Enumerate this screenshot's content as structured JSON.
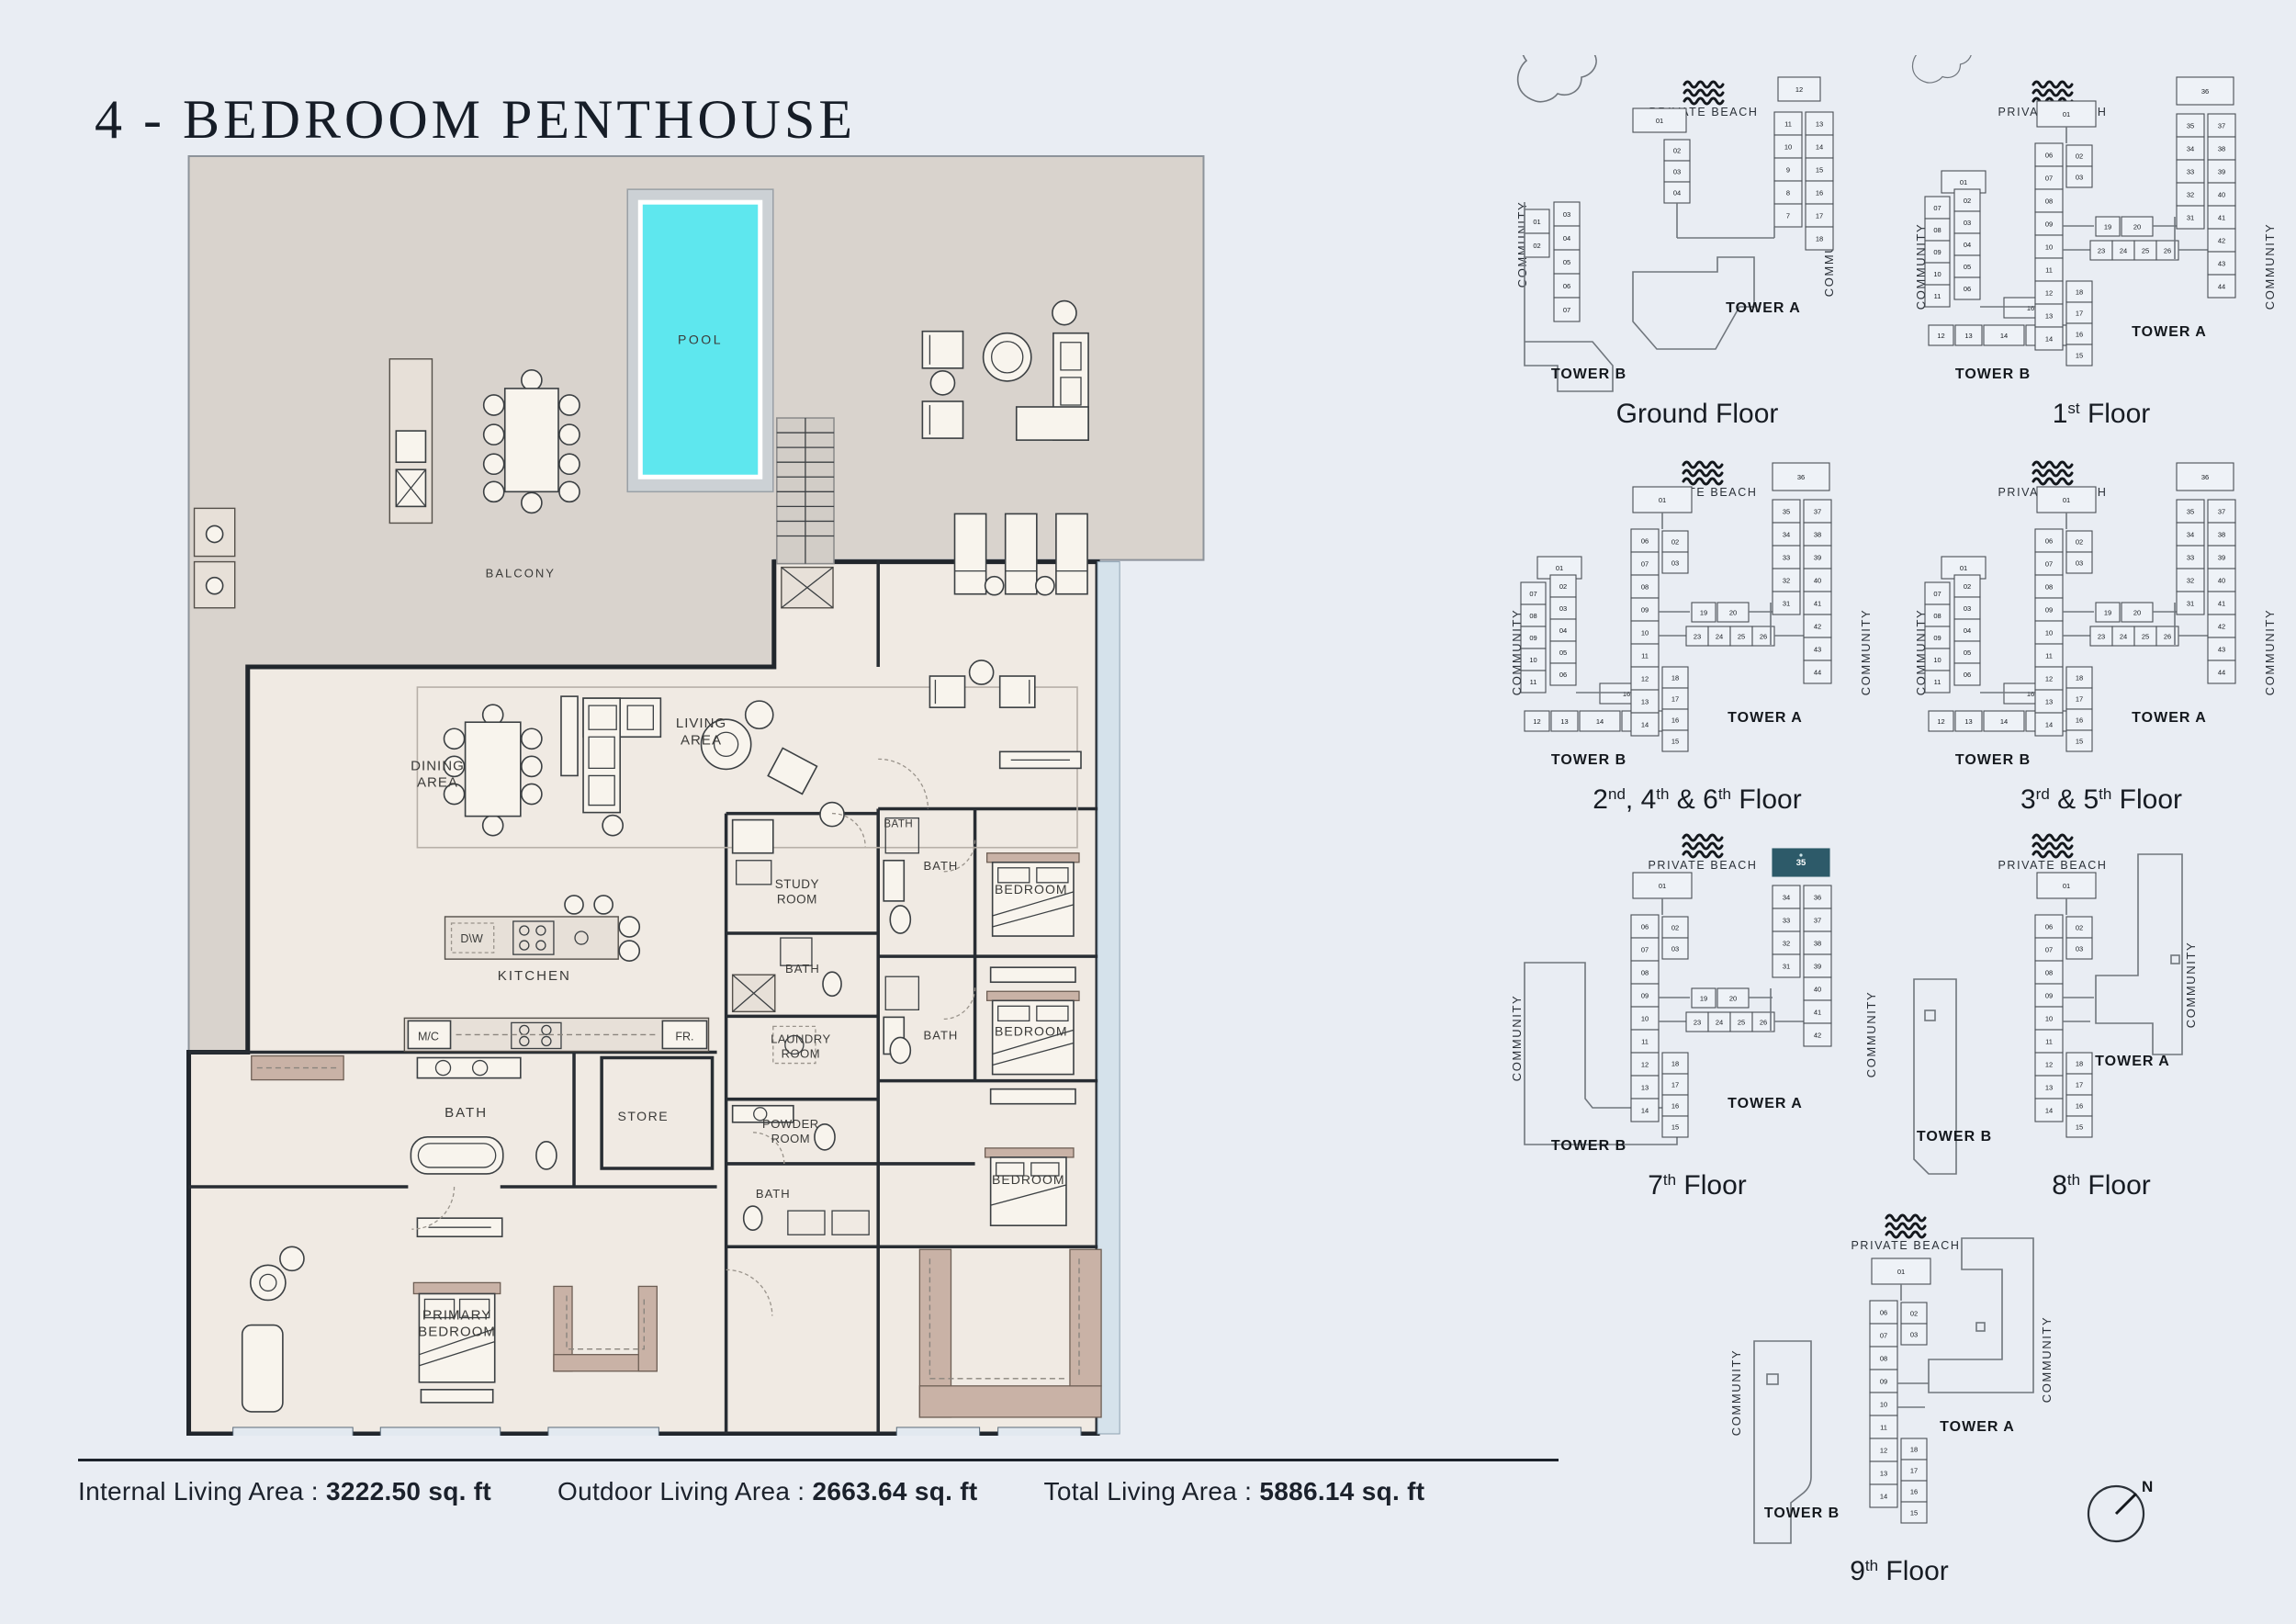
{
  "title": "4 - BEDROOM PENTHOUSE",
  "colors": {
    "highlight": "#2d5a69",
    "pool": "#5ee7ee",
    "background": "#e9edf3"
  },
  "plan": {
    "rooms": [
      {
        "id": "pool",
        "lines": [
          "POOL"
        ]
      },
      {
        "id": "balcony",
        "lines": [
          "BALCONY"
        ]
      },
      {
        "id": "dining",
        "lines": [
          "DINING",
          "AREA"
        ]
      },
      {
        "id": "living",
        "lines": [
          "LIVING",
          "AREA"
        ]
      },
      {
        "id": "kitchen",
        "lines": [
          "KITCHEN"
        ]
      },
      {
        "id": "dw",
        "lines": [
          "D\\W"
        ]
      },
      {
        "id": "mc",
        "lines": [
          "M/C"
        ]
      },
      {
        "id": "fr",
        "lines": [
          "FR."
        ]
      },
      {
        "id": "bath_main",
        "lines": [
          "BATH"
        ]
      },
      {
        "id": "store",
        "lines": [
          "STORE"
        ]
      },
      {
        "id": "primary",
        "lines": [
          "PRIMARY",
          "BEDROOM"
        ]
      },
      {
        "id": "study",
        "lines": [
          "STUDY",
          "ROOM"
        ]
      },
      {
        "id": "bath_study",
        "lines": [
          "BATH"
        ]
      },
      {
        "id": "laundry",
        "lines": [
          "LAUNDRY",
          "ROOM"
        ]
      },
      {
        "id": "powder",
        "lines": [
          "POWDER",
          "ROOM"
        ]
      },
      {
        "id": "bath_lower",
        "lines": [
          "BATH"
        ]
      },
      {
        "id": "bath_top",
        "lines": [
          "BATH"
        ]
      },
      {
        "id": "bath_en1",
        "lines": [
          "BATH"
        ]
      },
      {
        "id": "bath_en2",
        "lines": [
          "BATH"
        ]
      },
      {
        "id": "bedroom_1",
        "lines": [
          "BEDROOM"
        ]
      },
      {
        "id": "bedroom_2",
        "lines": [
          "BEDROOM"
        ]
      },
      {
        "id": "bedroom_3",
        "lines": [
          "BEDROOM"
        ]
      }
    ]
  },
  "keyplans": {
    "shared": {
      "private_beach": "PRIVATE BEACH",
      "community": "COMMUNITY",
      "tower_a": "TOWER A",
      "tower_b": "TOWER B"
    },
    "floors": [
      {
        "id": "ground",
        "caption": [
          {
            "t": "Ground Floor"
          }
        ],
        "tower_a": {
          "variant": "ground",
          "top01": "01",
          "side_col": [
            "02",
            "03",
            "04"
          ],
          "wing_top": "12",
          "pairs_left": [
            "11",
            "10",
            "9",
            "8",
            "7"
          ],
          "pairs_right": [
            "13",
            "14",
            "15",
            "16",
            "17"
          ],
          "tail": [
            "18"
          ]
        },
        "tower_b": {
          "variant": "ground",
          "left": [
            "01",
            "02"
          ],
          "right": [
            "03",
            "04",
            "05",
            "06",
            "07"
          ],
          "lagoon": true
        }
      },
      {
        "id": "first",
        "caption": [
          {
            "t": "1"
          },
          {
            "t": "st",
            "sup": true
          },
          {
            "t": " Floor"
          }
        ],
        "tower_a": {
          "variant": "full",
          "top01": "01",
          "left_col": [
            "06",
            "07",
            "08",
            "09",
            "10",
            "11",
            "12",
            "13",
            "14"
          ],
          "inner_top": [
            "02",
            "03"
          ],
          "inner_bottom": [
            "18",
            "17",
            "16",
            "15"
          ],
          "cross1": [
            "19",
            "20"
          ],
          "cross2": [
            "23",
            "24",
            "25",
            "26"
          ],
          "wing_top": "36",
          "pairs_left": [
            "35",
            "34",
            "33",
            "32",
            "31"
          ],
          "pairs_right": [
            "37",
            "38",
            "39",
            "40",
            "41"
          ],
          "tail": [
            "42",
            "43",
            "44"
          ]
        },
        "tower_b": {
          "variant": "units",
          "top": "01",
          "left": [
            "07",
            "08",
            "09",
            "10",
            "11"
          ],
          "right": [
            "02",
            "03",
            "04",
            "05",
            "06"
          ],
          "arm": "16",
          "bottom": [
            "12",
            "13",
            "14",
            "15"
          ],
          "lagoon": true
        }
      },
      {
        "id": "f246",
        "caption": [
          {
            "t": "2"
          },
          {
            "t": "nd",
            "sup": true
          },
          {
            "t": ", 4"
          },
          {
            "t": "th",
            "sup": true
          },
          {
            "t": " & 6"
          },
          {
            "t": "th",
            "sup": true
          },
          {
            "t": " Floor"
          }
        ],
        "tower_a": {
          "variant": "full",
          "top01": "01",
          "left_col": [
            "06",
            "07",
            "08",
            "09",
            "10",
            "11",
            "12",
            "13",
            "14"
          ],
          "inner_top": [
            "02",
            "03"
          ],
          "inner_bottom": [
            "18",
            "17",
            "16",
            "15"
          ],
          "cross1": [
            "19",
            "20"
          ],
          "cross2": [
            "23",
            "24",
            "25",
            "26"
          ],
          "wing_top": "36",
          "pairs_left": [
            "35",
            "34",
            "33",
            "32",
            "31"
          ],
          "pairs_right": [
            "37",
            "38",
            "39",
            "40",
            "41"
          ],
          "tail": [
            "42",
            "43",
            "44"
          ]
        },
        "tower_b": {
          "variant": "units",
          "top": "01",
          "left": [
            "07",
            "08",
            "09",
            "10",
            "11"
          ],
          "right": [
            "02",
            "03",
            "04",
            "05",
            "06"
          ],
          "arm": "16",
          "bottom": [
            "12",
            "13",
            "14",
            "15"
          ],
          "lagoon": false
        }
      },
      {
        "id": "f35",
        "caption": [
          {
            "t": "3"
          },
          {
            "t": "rd",
            "sup": true
          },
          {
            "t": " & 5"
          },
          {
            "t": "th",
            "sup": true
          },
          {
            "t": " Floor"
          }
        ],
        "tower_a": {
          "variant": "full",
          "top01": "01",
          "left_col": [
            "06",
            "07",
            "08",
            "09",
            "10",
            "11",
            "12",
            "13",
            "14"
          ],
          "inner_top": [
            "02",
            "03"
          ],
          "inner_bottom": [
            "18",
            "17",
            "16",
            "15"
          ],
          "cross1": [
            "19",
            "20"
          ],
          "cross2": [
            "23",
            "24",
            "25",
            "26"
          ],
          "wing_top": "36",
          "pairs_left": [
            "35",
            "34",
            "33",
            "32",
            "31"
          ],
          "pairs_right": [
            "37",
            "38",
            "39",
            "40",
            "41"
          ],
          "tail": [
            "42",
            "43",
            "44"
          ]
        },
        "tower_b": {
          "variant": "units",
          "top": "01",
          "left": [
            "07",
            "08",
            "09",
            "10",
            "11"
          ],
          "right": [
            "02",
            "03",
            "04",
            "05",
            "06"
          ],
          "arm": "16",
          "bottom": [
            "12",
            "13",
            "14",
            "15"
          ],
          "lagoon": false
        }
      },
      {
        "id": "f7",
        "caption": [
          {
            "t": "7"
          },
          {
            "t": "th",
            "sup": true
          },
          {
            "t": " Floor"
          }
        ],
        "tower_a": {
          "variant": "full",
          "top01": "01",
          "left_col": [
            "06",
            "07",
            "08",
            "09",
            "10",
            "11",
            "12",
            "13",
            "14"
          ],
          "inner_top": [
            "02",
            "03"
          ],
          "inner_bottom": [
            "18",
            "17",
            "16",
            "15"
          ],
          "cross1": [
            "19",
            "20"
          ],
          "cross2": [
            "23",
            "24",
            "25",
            "26"
          ],
          "wing_top": "35",
          "wing_top_highlight": true,
          "pairs_left": [
            "34",
            "33",
            "32",
            "31"
          ],
          "pairs_right": [
            "36",
            "37",
            "38",
            "39"
          ],
          "tail": [
            "40",
            "41",
            "42"
          ]
        },
        "tower_b": {
          "variant": "outlineL"
        }
      },
      {
        "id": "f8",
        "caption": [
          {
            "t": "8"
          },
          {
            "t": "th",
            "sup": true
          },
          {
            "t": " Floor"
          }
        ],
        "tower_a": {
          "variant": "halfC",
          "top01": "01",
          "left_col": [
            "06",
            "07",
            "08",
            "09",
            "10",
            "11",
            "12",
            "13",
            "14"
          ],
          "inner_top": [
            "02",
            "03"
          ],
          "inner_bottom": [
            "18",
            "17",
            "16",
            "15"
          ]
        },
        "tower_b": {
          "variant": "outline8"
        }
      },
      {
        "id": "f9",
        "caption": [
          {
            "t": "9"
          },
          {
            "t": "th",
            "sup": true
          },
          {
            "t": " Floor"
          }
        ],
        "tower_a": {
          "variant": "halfL",
          "top01": "01",
          "left_col": [
            "06",
            "07",
            "08",
            "09",
            "10",
            "11",
            "12",
            "13",
            "14"
          ],
          "inner_top": [
            "02",
            "03"
          ],
          "inner_bottom": [
            "18",
            "17",
            "16",
            "15"
          ]
        },
        "tower_b": {
          "variant": "outline9"
        }
      }
    ]
  },
  "footer": {
    "items": [
      {
        "label": "Internal Living Area :",
        "value": "3222.50 sq. ft"
      },
      {
        "label": "Outdoor Living Area :",
        "value": "2663.64 sq. ft"
      },
      {
        "label": "Total Living Area :",
        "value": "5886.14 sq. ft"
      }
    ]
  },
  "compass": {
    "label": "N"
  }
}
